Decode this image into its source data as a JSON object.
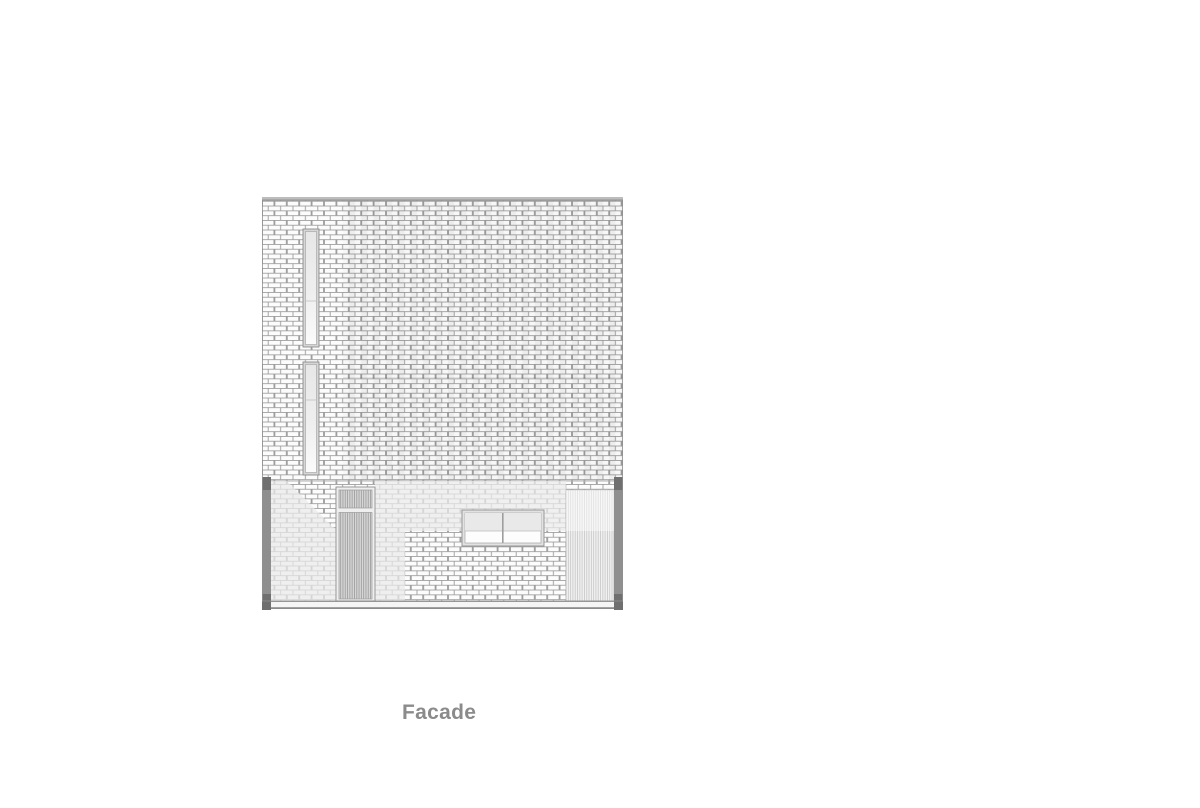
{
  "caption": {
    "label": "Facade"
  },
  "drawing": {
    "kind": "architectural-elevation",
    "view_name": "Facade",
    "elements": [
      "brick-facade-wall",
      "roof-coping",
      "upper-slot-window",
      "lower-slot-window",
      "louvered-entry-door",
      "ground-floor-window",
      "louvered-screen",
      "left-column",
      "right-column",
      "base-plinth"
    ],
    "colors": {
      "page_background": "#ffffff",
      "brick_fill": "#fcfcfc",
      "mortar_joint": "#9c9c9c",
      "coping_gray": "#bdbdbd",
      "column_gray": "#8f8f8f",
      "column_dark": "#6f6f6f",
      "louver_dark_fill": "#d6d6d6",
      "louver_dark_line": "#a0a0a0",
      "louver_light_fill": "#f1f1f1",
      "louver_light_line": "#c6c6c6",
      "window_frame": "#e2e2e2",
      "glazing_tint": "#e9e9e9",
      "caption_text": "#8b8b8b"
    }
  }
}
